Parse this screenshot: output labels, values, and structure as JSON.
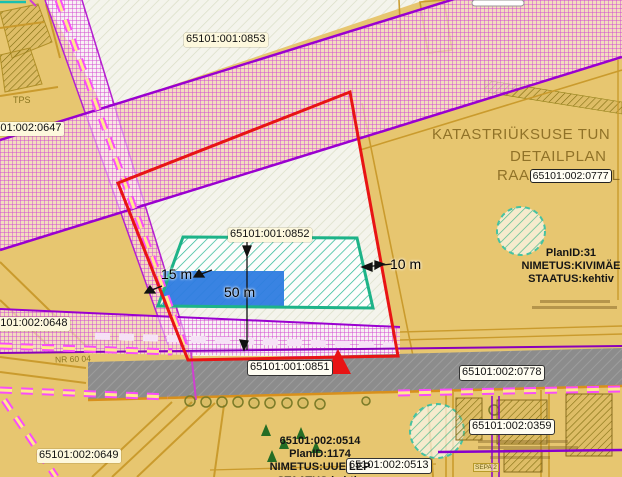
{
  "app": {
    "name": "cadastral-map-viewer"
  },
  "map_labels": {
    "p0853": "65101:001:0853",
    "p0647": "65101:002:0647",
    "p0852": "65101:001:0852",
    "p0648": "65101:002:0648",
    "p0851": "65101:001:0851",
    "p0649": "65101:002:0649",
    "p0778": "65101:002:0778",
    "p0359": "65101:002:0359",
    "p0777": "65101:002:0777",
    "p0513": "65101:002:0513",
    "p0514": "65101:002:0514"
  },
  "title_overlay": {
    "line1": "KATASTRIÜKSUSE TUN",
    "line2": "DETAILPLAN",
    "line3_prefix": "RAA",
    "line3_suffix": "L"
  },
  "plan_block_right": {
    "plan_id": "PlanID:31",
    "name": "NIMETUS:KIVIMÄE",
    "status": "STAATUS:kehtiv"
  },
  "plan_block_bottom": {
    "plan_id": "PlanID:1174",
    "name": "NIMETUS:UUE LEP",
    "status": "STAATUS:kehtiv"
  },
  "measurements": {
    "width_left": "15 m",
    "length": "50 m",
    "width_right": "10 m"
  },
  "road_label": "NR 60 04",
  "misc_labels": {
    "tps": "TPS",
    "sepa": "SEPA 2"
  },
  "marker": {
    "shape": "triangle"
  },
  "colors": {
    "boundary_red": "#e81414",
    "parcel_green": "#1db388",
    "highlight_blue": "#2e7ce0",
    "hatch_magenta": "#d24ad2",
    "band_border_purple": "#9a00d0",
    "road_gray": "#8c8c8c",
    "base_tan": "#e7c670",
    "teal": "#1ec2ae",
    "title_brown": "#84671e"
  }
}
